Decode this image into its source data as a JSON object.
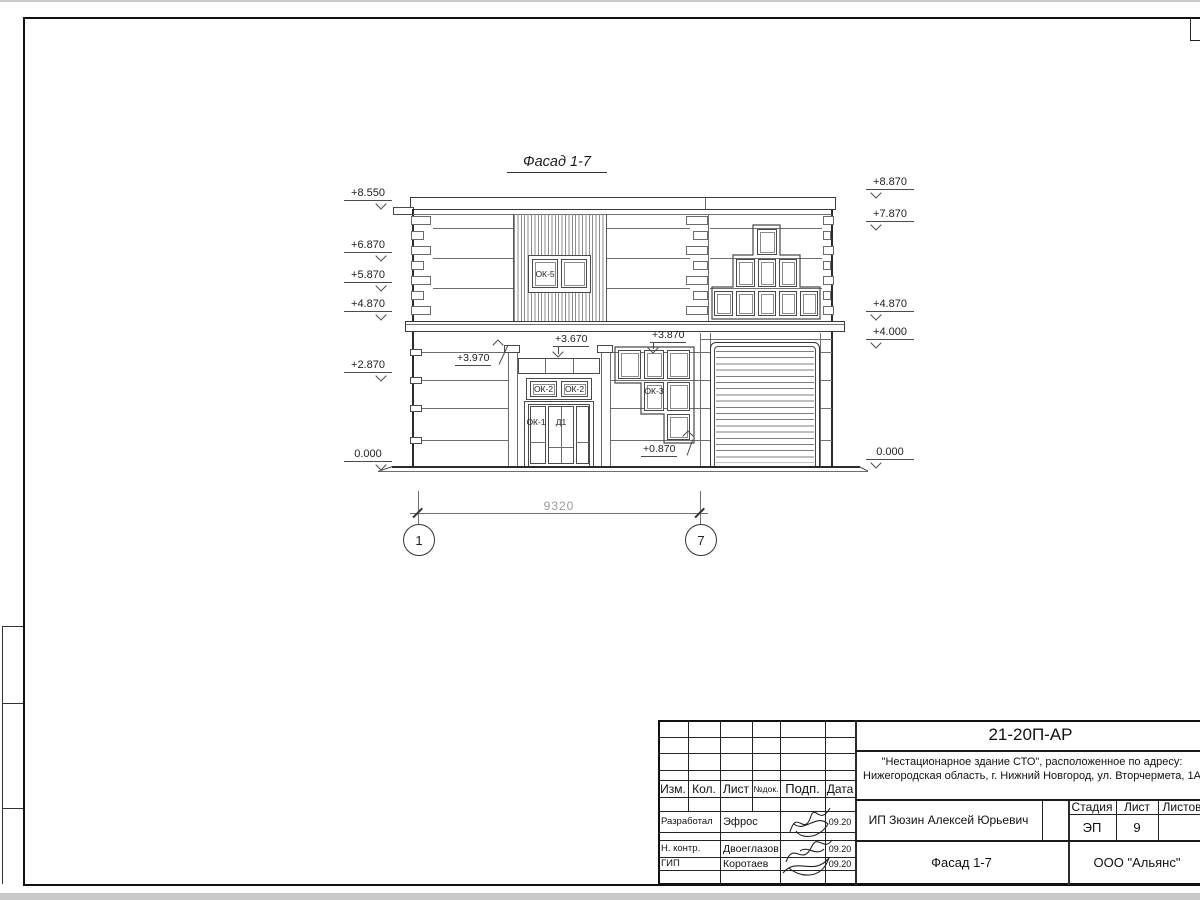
{
  "sheet": {
    "drawing_title": "Фасад 1-7",
    "elev_left": [
      "+8.550",
      "+6.870",
      "+5.870",
      "+4.870",
      "+2.870",
      "0.000"
    ],
    "elev_right": [
      "+8.870",
      "+7.870",
      "+4.870",
      "+4.000",
      "0.000"
    ],
    "annotations": {
      "portal_top": "+3.970",
      "transom": "+3.670",
      "ok3_top": "+3.870",
      "ok3_bottom": "+0.870"
    },
    "labels": {
      "ok5": "ОК-5",
      "ok2a": "ОК-2",
      "ok2b": "ОК-2",
      "ok3": "ОК-3",
      "ok1": "ОК-1",
      "d1": "Д1"
    },
    "dimension": "9320",
    "axis_left": "1",
    "axis_right": "7"
  },
  "title_block": {
    "doc_number": "21-20П-АР",
    "project_line1": "\"Нестационарное здание СТО\", расположенное по адресу:",
    "project_line2": "Нижегородская область, г. Нижний Новгород, ул. Вторчермета, 1А",
    "client": "ИП Зюзин Алексей Юрьевич",
    "drawing_title": "Фасад 1-7",
    "company": "ООО \"Альянс\"",
    "stage_label": "Стадия",
    "sheet_label": "Лист",
    "sheets_label": "Листов",
    "stage_value": "ЭП",
    "sheet_value": "9",
    "header": {
      "izm": "Изм.",
      "kol": "Кол.",
      "list": "Лист",
      "ndok": "№док.",
      "podp": "Подп.",
      "data": "Дата"
    },
    "rows": [
      {
        "role": "Разработал",
        "name": "Эфрос",
        "date": "09.20"
      },
      {
        "role": "Н. контр.",
        "name": "Двоеглазов",
        "date": "09.20"
      },
      {
        "role": "ГИП",
        "name": "Коротаев",
        "date": "09.20"
      }
    ]
  },
  "colors": {
    "line": "#3a3a3a",
    "frame": "#111111",
    "dim_text": "#9a9a9a"
  }
}
